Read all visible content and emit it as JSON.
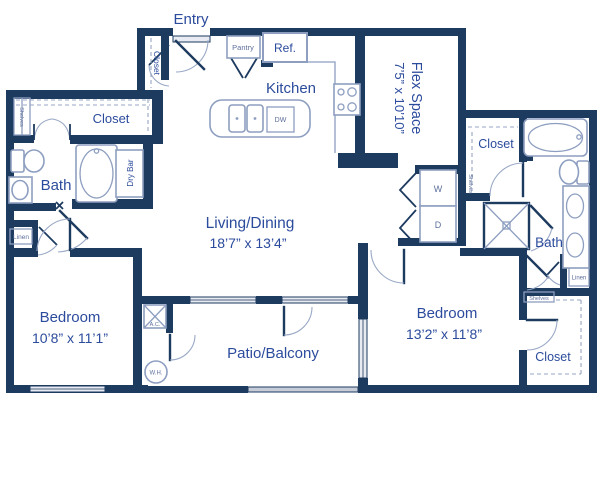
{
  "palette": {
    "wall_navy": "#1d3a5f",
    "label_blue": "#2b4b9c",
    "small_label_blue": "#5d6f9b",
    "fixture_stroke": "#8d9ec0",
    "window_fill": "#e8ebf1",
    "rail_fill": "#c6cdd8"
  },
  "labels": {
    "entry": "Entry",
    "entry_closet": "Closet",
    "pantry": "Pantry",
    "ref": "Ref.",
    "kitchen": "Kitchen",
    "dw": "DW",
    "flex_name": "Flex Space",
    "flex_dims": "7’5” x 10’10”",
    "closet_left": "Closet",
    "shelves_left": "Shelves",
    "bath_left": "Bath",
    "dry_bar": "Dry Bar",
    "linen_left": "Linen",
    "living_name": "Living/Dining",
    "living_dims": "18’7” x 13’4”",
    "bedroom1_name": "Bedroom",
    "bedroom1_dims": "10’8” x 11’1”",
    "ac": "A.C.",
    "wh": "W.H.",
    "patio": "Patio/Balcony",
    "washer": "W",
    "dryer": "D",
    "closet_master": "Closet",
    "shelves_master": "Shelves",
    "bath_right": "Bath",
    "linen_right": "Linen",
    "shelves_closet2": "Shelves",
    "bedroom2_name": "Bedroom",
    "bedroom2_dims": "13’2” x 11’8”",
    "closet2": "Closet"
  }
}
